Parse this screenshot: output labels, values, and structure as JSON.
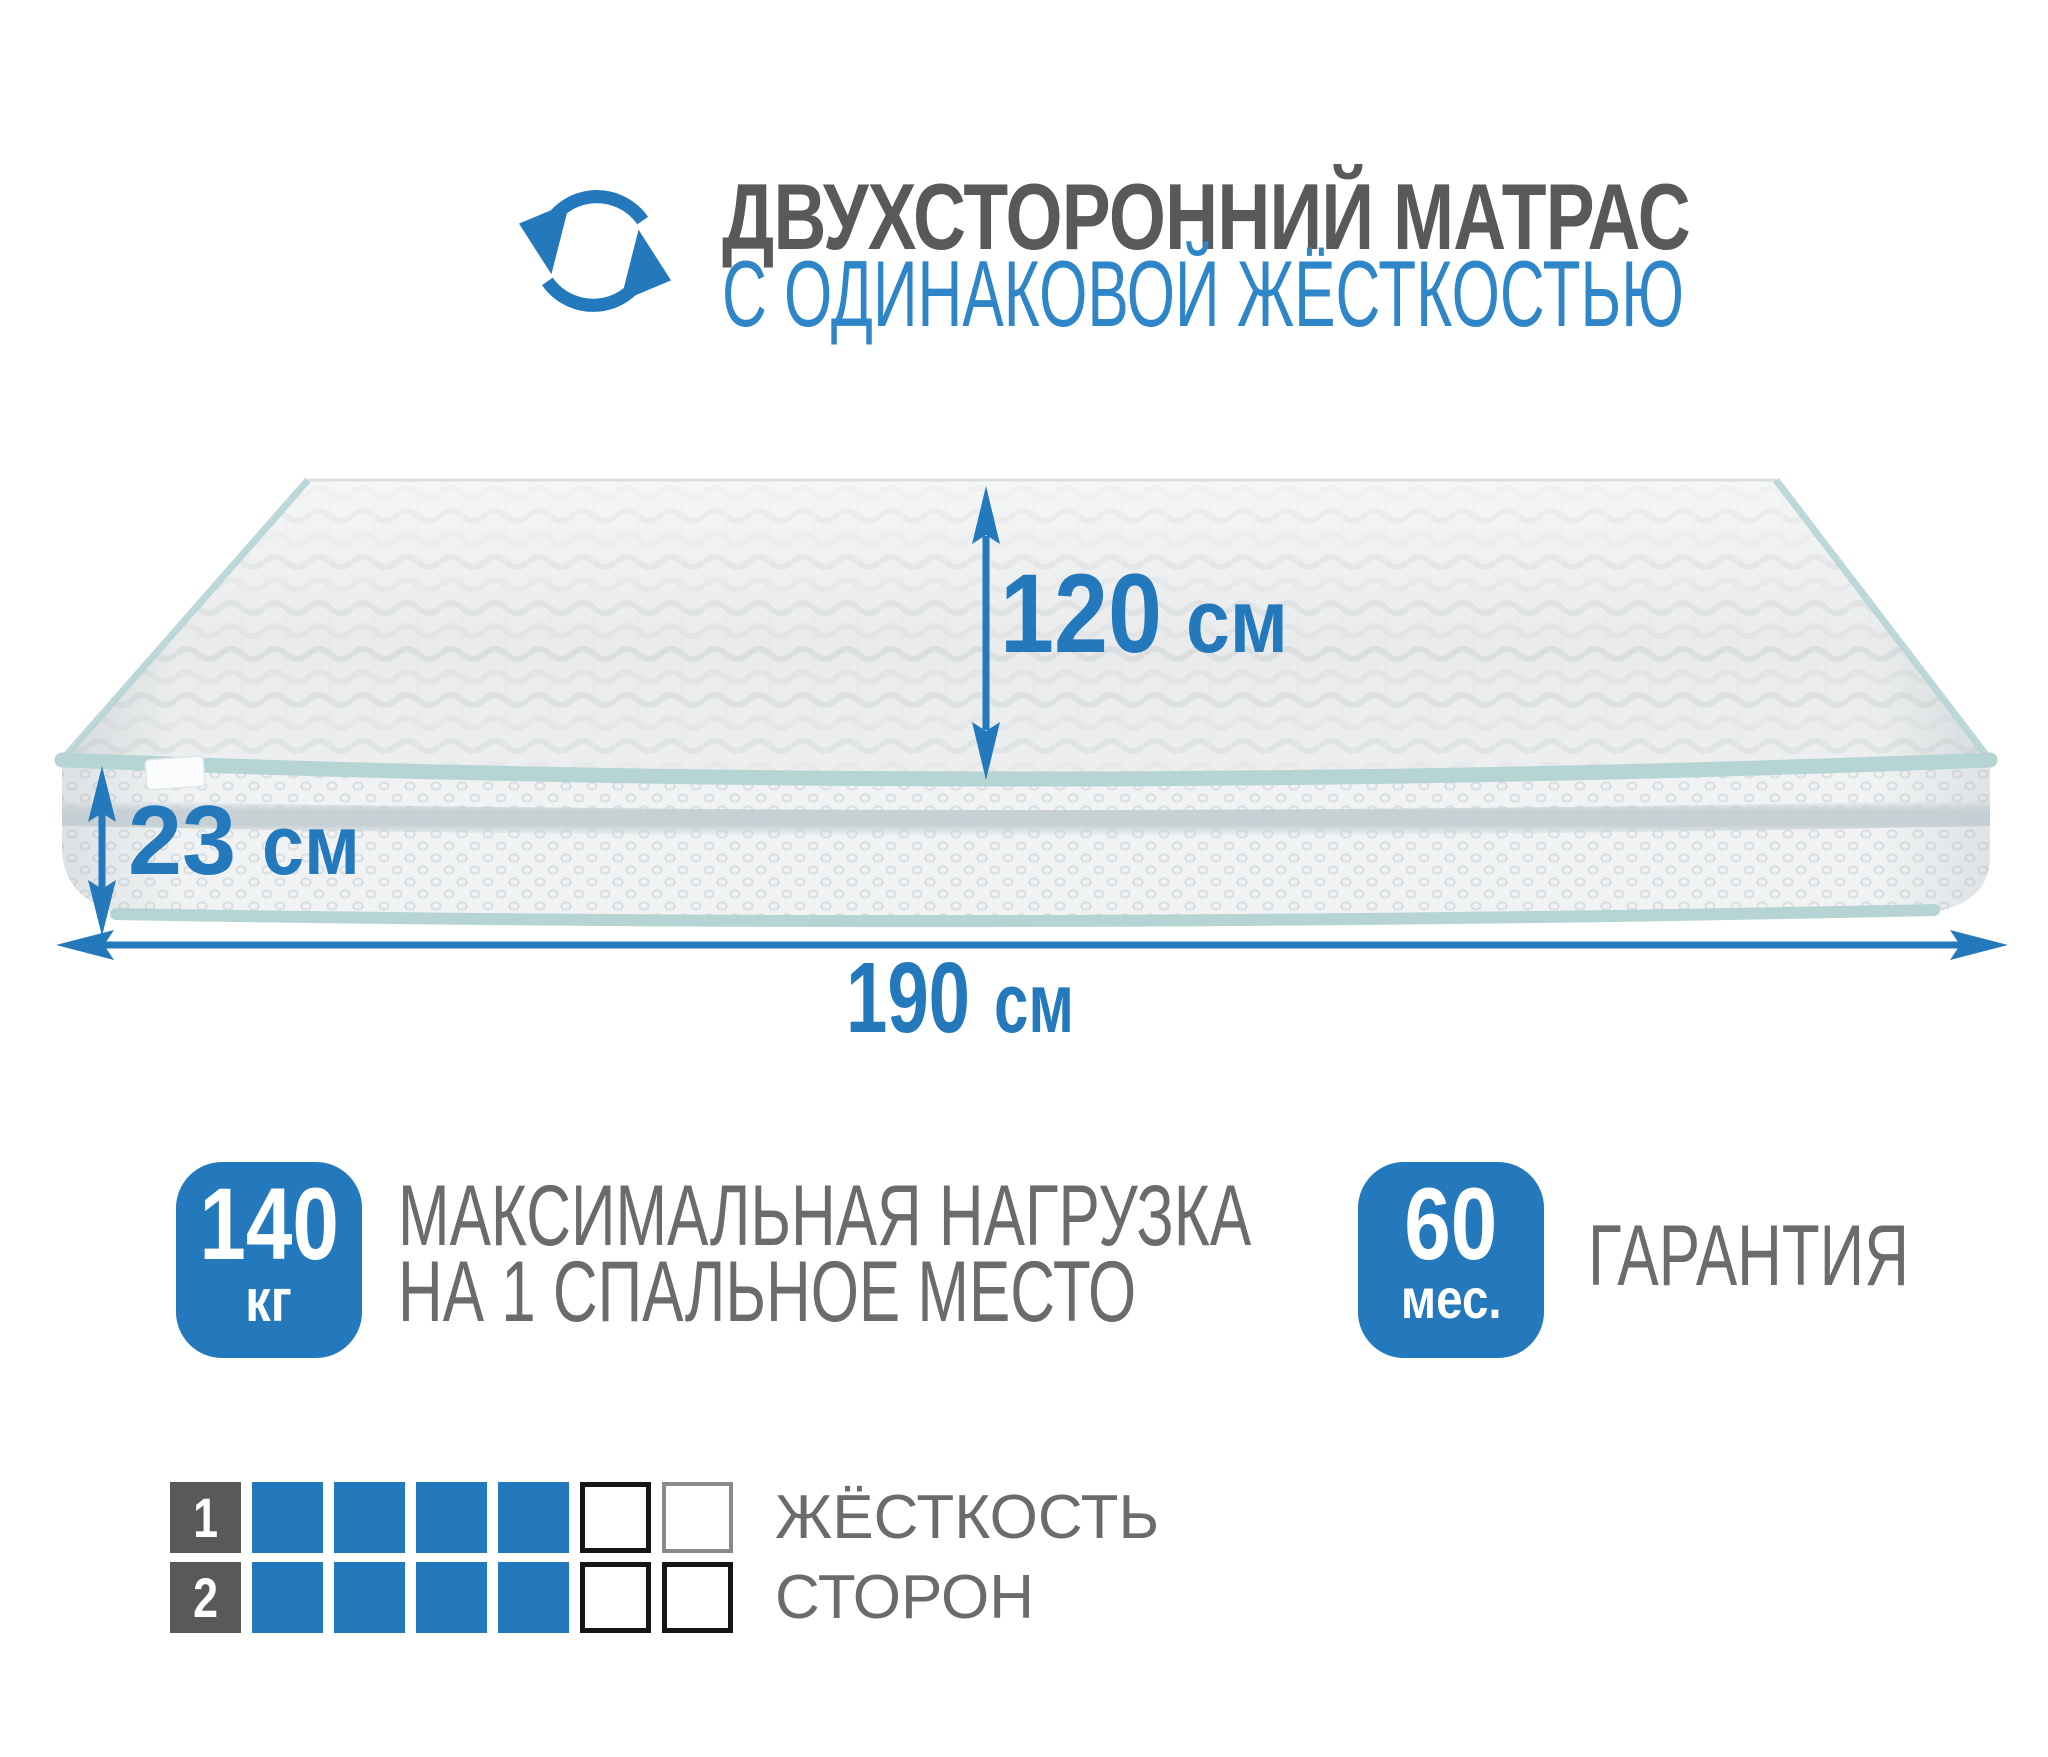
{
  "header": {
    "icon": "rotate-arrows",
    "title_line1": "ДВУХСТОРОННИЙ МАТРАС",
    "title_line2": "С ОДИНАКОВОЙ ЖЁСТКОСТЬЮ"
  },
  "mattress": {
    "dimensions": {
      "width_value": "120",
      "width_unit": "см",
      "height_value": "23",
      "height_unit": "см",
      "length_value": "190",
      "length_unit": "см"
    }
  },
  "features": {
    "max_load": {
      "badge_value": "140",
      "badge_unit": "кг",
      "label_line1": "МАКСИМАЛЬНАЯ НАГРУЗКА",
      "label_line2": "НА 1 СПАЛЬНОЕ МЕСТО"
    },
    "warranty": {
      "badge_value": "60",
      "badge_unit": "мес.",
      "label": "ГАРАНТИЯ"
    }
  },
  "firmness_scale": {
    "rows": [
      {
        "number": "1",
        "filled": 4,
        "total": 6
      },
      {
        "number": "2",
        "filled": 4,
        "total": 6
      }
    ],
    "label_line1": "ЖЁСТКОСТЬ",
    "label_line2": "СТОРОН"
  },
  "colors": {
    "accent_blue": "#2478bc",
    "subtitle_blue": "#2e86c8",
    "title_gray": "#58595b",
    "label_gray": "#6a6b6d",
    "piping_mint": "#b7d4d5"
  }
}
